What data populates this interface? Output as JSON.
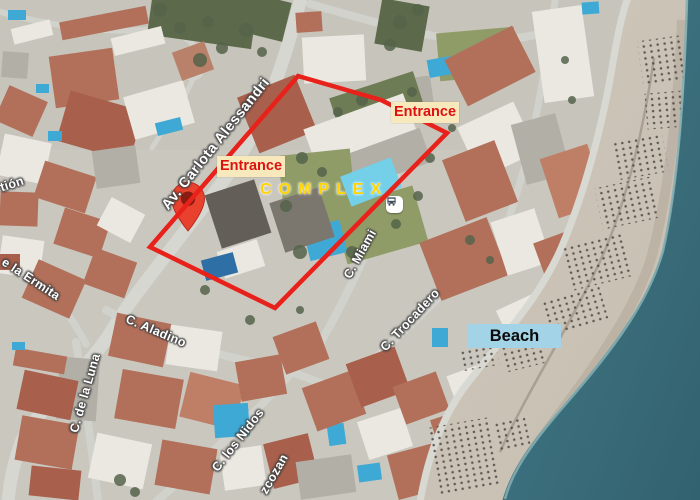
{
  "labels": {
    "entrance_nw": "Entrance",
    "entrance_ne": "Entrance",
    "complex": "COMPLEX",
    "beach": "Beach"
  },
  "streets": {
    "avenue": "Av. Carlota Alessandri",
    "aladino": "C. Aladino",
    "luna": "C. de la Luna",
    "ermita_partial": "e la Ermita",
    "tion_partial": "tión",
    "nidos": "C. los Nidos",
    "zcozan_partial": "zcozan",
    "miami": "C. Miami",
    "trocadero": "C. Trocadero"
  },
  "icons": {
    "bus_stop": "bus-stop-icon",
    "location_pin": "location-pin-icon"
  },
  "colors": {
    "route_outline": "#e8211b",
    "entrance_bg": "#f7e9bc",
    "entrance_text": "#dd1210",
    "complex_text": "#ffd400",
    "beach_bg": "#a3d3e6",
    "beach_text": "#0a0a0a",
    "pin_red": "#e8422e",
    "pin_inner": "#8a1d12",
    "sea": "#32616f",
    "sand": "#c6beb1"
  }
}
